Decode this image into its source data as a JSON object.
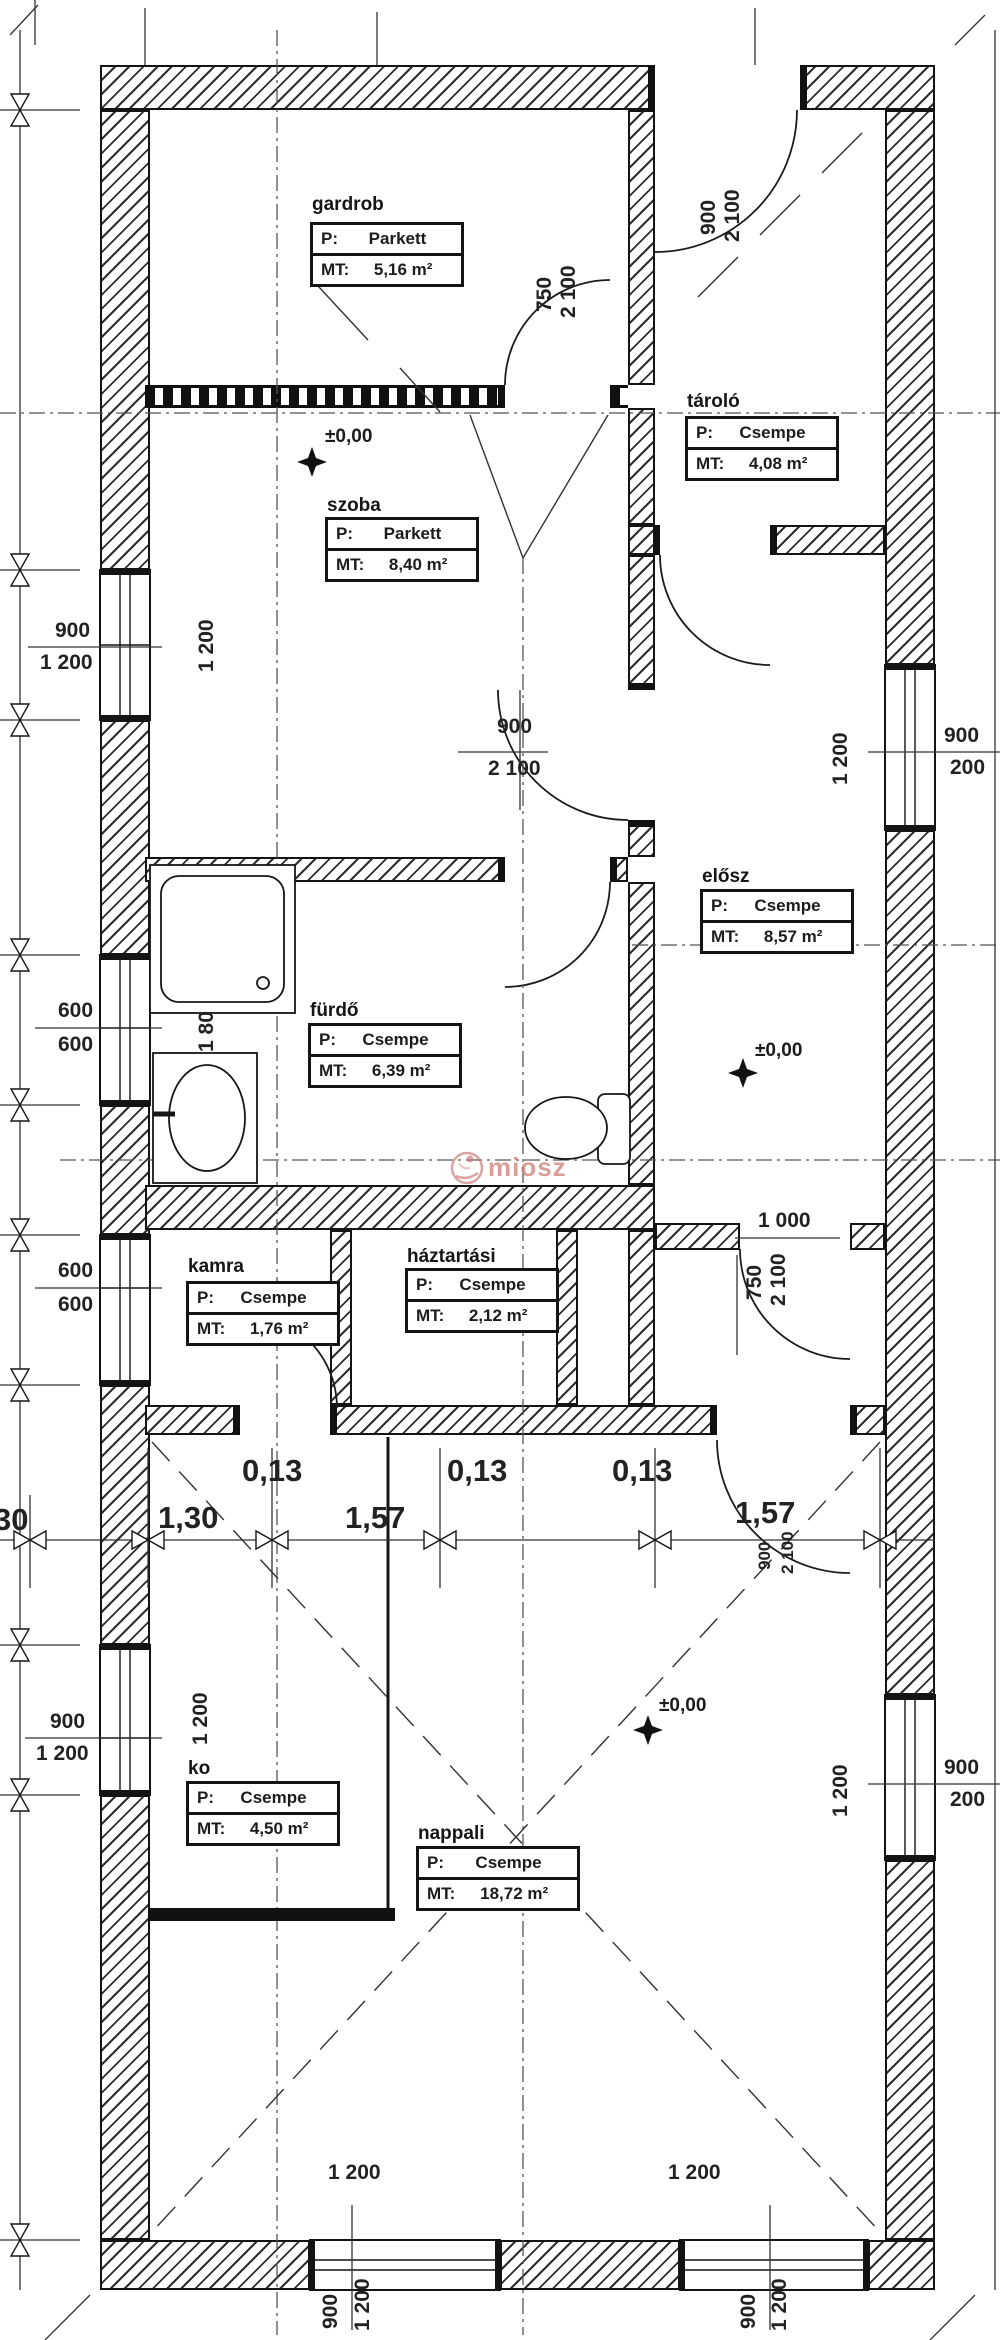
{
  "rooms": [
    {
      "name": "gardrob",
      "p": "Parkett",
      "mt": "5,16 m²"
    },
    {
      "name": "szoba",
      "p": "Parkett",
      "mt": "8,40 m²"
    },
    {
      "name": "tároló",
      "p": "Csempe",
      "mt": "4,08 m²"
    },
    {
      "name": "elősz",
      "p": "Csempe",
      "mt": "8,57 m²"
    },
    {
      "name": "fürdő",
      "p": "Csempe",
      "mt": "6,39 m²"
    },
    {
      "name": "kamra",
      "p": "Csempe",
      "mt": "1,76 m²"
    },
    {
      "name": "háztartási",
      "p": "Csempe",
      "mt": "2,12 m²"
    },
    {
      "name": "ko",
      "p": "Csempe",
      "mt": "4,50 m²"
    },
    {
      "name": "nappali",
      "p": "Csempe",
      "mt": "18,72 m²"
    }
  ],
  "keys": {
    "p": "P:",
    "mt": "MT:"
  },
  "level_marker": "±0,00",
  "watermark": "miosz",
  "dims": {
    "chain": [
      "30",
      "1,30",
      "0,13",
      "1,57",
      "0,13",
      "0,13",
      "1,57"
    ],
    "left_w1_top": "900",
    "left_w1_bot": "1 200",
    "left_w1_side": "1 200",
    "left_w2_top": "600",
    "left_w2_bot": "600",
    "left_w3_top": "600",
    "left_w3_bot": "600",
    "left_w4_top": "900",
    "left_w4_bot": "1 200",
    "left_w4_side": "1 200",
    "right_w1_top": "900",
    "right_w1_bot": "200",
    "right_w1_side": "1 200",
    "right_w2_top": "900",
    "right_w2_bot": "200",
    "right_w2_side": "1 200",
    "bot_w1_label": "1 200",
    "bot_w1_a": "900",
    "bot_w1_b": "1 200",
    "bot_w2_label": "1 200",
    "bot_w2_a": "900",
    "bot_w2_b": "1 200",
    "door_gardrob_w": "750",
    "door_gardrob_h": "2 100",
    "door_entry_w": "900",
    "door_entry_h": "2 100",
    "door_szoba_w": "900",
    "door_szoba_h": "2 100",
    "door_hall_a": "1 000",
    "door_hall_w": "750",
    "door_hall_h": "2 100",
    "door_nappali_w": "900",
    "door_nappali_h": "2 100",
    "shower": "1 80"
  }
}
